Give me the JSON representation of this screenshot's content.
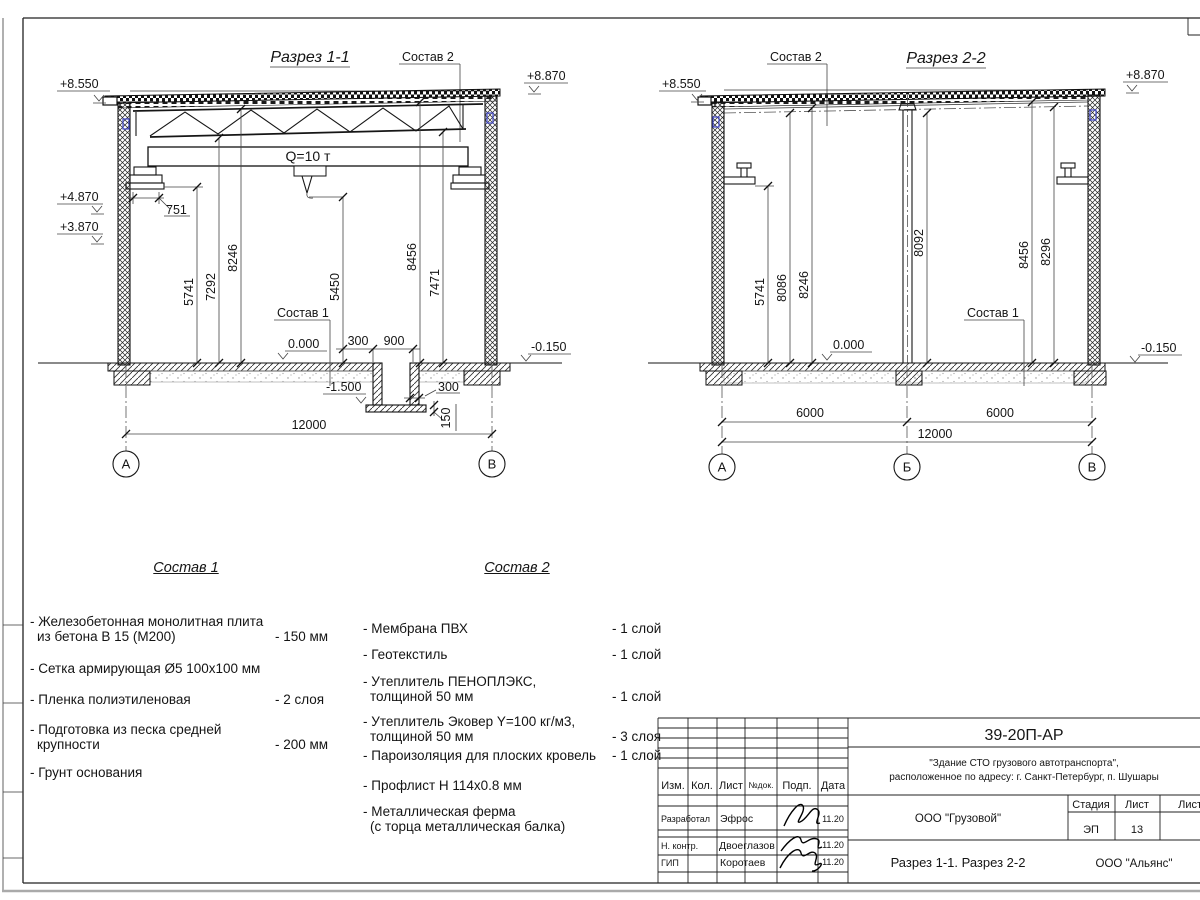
{
  "callouts": {
    "c1": "Состав 1",
    "c2": "Состав 2"
  },
  "s1": {
    "title": "Разрез 1-1",
    "crane": "Q=10 т",
    "lvl_tl": "+8.550",
    "lvl_tr": "+8.870",
    "lvl_m1": "+4.870",
    "lvl_m2": "+3.870",
    "lvl_fl": "0.000",
    "lvl_gr": "-0.150",
    "lvl_pit": "-1.500",
    "d751": "751",
    "vdims": [
      "5741",
      "7292",
      "8246",
      "5450",
      "8456",
      "7471"
    ],
    "pit": {
      "w1": "300",
      "w2": "900",
      "w3": "300",
      "t": "150"
    },
    "span": "12000",
    "ax": [
      "А",
      "В"
    ]
  },
  "s2": {
    "title": "Разрез 2-2",
    "lvl_tl": "+8.550",
    "lvl_tr": "+8.870",
    "lvl_fl": "0.000",
    "lvl_gr": "-0.150",
    "vdims": [
      "5741",
      "8086",
      "8246",
      "8092",
      "8456",
      "8296"
    ],
    "spans": [
      "6000",
      "6000",
      "12000"
    ],
    "ax": [
      "А",
      "Б",
      "В"
    ]
  },
  "sostav1": {
    "title": "Состав 1",
    "items": [
      {
        "l1": "- Железобетонная  монолитная плита",
        "l2": "из бетона В 15 (М200)",
        "val": "- 150 мм"
      },
      {
        "l1": "- Сетка армирующая Ø5 100х100 мм",
        "l2": "",
        "val": ""
      },
      {
        "l1": "- Пленка полиэтиленовая",
        "l2": "",
        "val": "-  2 слоя"
      },
      {
        "l1": "- Подготовка из песка средней",
        "l2": "крупности",
        "val": "- 200 мм"
      },
      {
        "l1": "- Грунт основания",
        "l2": "",
        "val": ""
      }
    ]
  },
  "sostav2": {
    "title": "Состав 2",
    "items": [
      {
        "l1": "- Мембрана ПВХ",
        "l2": "",
        "val": "- 1 слой"
      },
      {
        "l1": "- Геотекстиль",
        "l2": "",
        "val": "- 1 слой"
      },
      {
        "l1": "- Утеплитель ПЕНОПЛЭКС,",
        "l2": "толщиной 50 мм",
        "val": "- 1 слой"
      },
      {
        "l1": "- Утеплитель Эковер Y=100 кг/м3,",
        "l2": "толщиной 50 мм",
        "val": "- 3 слоя"
      },
      {
        "l1": "- Пароизоляция для плоских кровель",
        "l2": "",
        "val": "- 1 слой"
      },
      {
        "l1": "- Профлист Н 114х0.8 мм",
        "l2": "",
        "val": ""
      },
      {
        "l1": "- Металлическая ферма",
        "l2": "(с торца металлическая балка)",
        "val": ""
      }
    ]
  },
  "tb": {
    "code": "39-20П-АР",
    "proj1": "\"Здание СТО грузового автотранспорта\",",
    "proj2": "расположенное по адресу: г. Санкт-Петербург, п. Шушары",
    "h_izm": "Изм.",
    "h_kol": "Кол.",
    "h_list": "Лист",
    "h_ndoc": "№док.",
    "h_podp": "Подп.",
    "h_data": "Дата",
    "rows": [
      {
        "role": "Разработал",
        "name": "Эфрос",
        "date": "11.20"
      },
      {
        "role": "Н. контр.",
        "name": "Двоеглазов",
        "date": "11.20"
      },
      {
        "role": "ГИП",
        "name": "Коротаев",
        "date": "11.20"
      }
    ],
    "org": "ООО \"Грузовой\"",
    "h_stage": "Стадия",
    "h_sheet": "Лист",
    "h_sheets": "Листов",
    "stage": "ЭП",
    "sheet_no": "13",
    "obj": "Разрез 1-1. Разрез 2-2",
    "company": "ООО \"Альянс\""
  }
}
